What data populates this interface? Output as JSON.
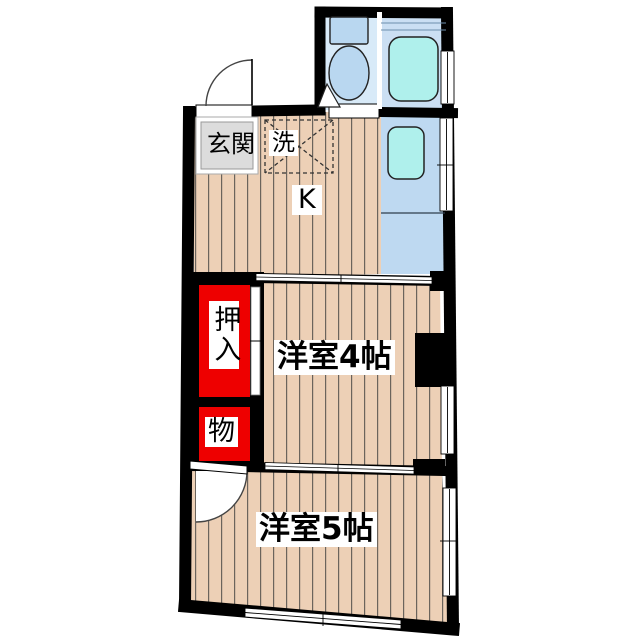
{
  "plan_title": "apartment-floor-plan",
  "labels": {
    "entrance": "玄関",
    "laundry": "洗",
    "kitchen": "K",
    "closet": "押入",
    "storage": "物",
    "room4": "洋室4帖",
    "room5": "洋室5帖"
  },
  "colors": {
    "wall": "#000000",
    "wood_floor": "#edd0b6",
    "wood_stripe": "#6b645c",
    "toilet_floor": "#d8eaf8",
    "bath_floor": "#cbdff3",
    "kitchen_counter": "#bed9f1",
    "fixture_cyan": "#aff0ec",
    "toilet_fixture": "#b9d7f0",
    "entrance_gray": "#dcdcdc",
    "closet_red": "#ee0000",
    "opening_white": "#ffffff"
  }
}
